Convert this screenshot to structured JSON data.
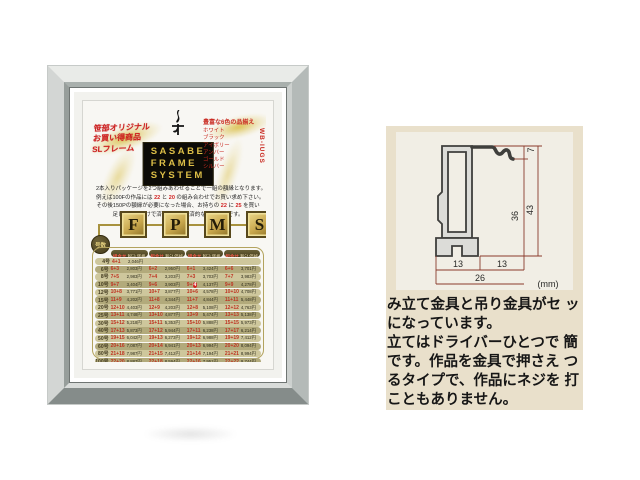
{
  "frame_photo": {
    "poster": {
      "promo_left_lines": [
        "笹部オリジナル",
        "お買い得商品",
        "SLフレーム"
      ],
      "brand_box_lines": [
        "SASABE",
        "FRAME",
        "SYSTEM"
      ],
      "colors_right": {
        "heading": "豊富な6色の品揃え",
        "names": [
          "ホワイト",
          "ブラック",
          "アイボリー",
          "アンバー",
          "ゴールド",
          "シルバー"
        ],
        "codes_vertical": "WB-IUGS"
      },
      "description_lines": [
        [
          {
            "t": "2本入りパッケージを2つ組みあわせることで一組の額縁となります。"
          }
        ],
        [
          {
            "t": "例えば100Fの作品には "
          },
          {
            "t": "22",
            "red": true
          },
          {
            "t": " と "
          },
          {
            "t": "20",
            "red": true
          },
          {
            "t": " の組み合わせでお買い求め下さい。"
          }
        ],
        [
          {
            "t": "その後150Pの額縁が必要になった場合、お持ちの "
          },
          {
            "t": "22",
            "red": true
          },
          {
            "t": " に "
          },
          {
            "t": "25",
            "red": true
          },
          {
            "t": " を買い"
          }
        ],
        [
          {
            "t": "足して頂くだけで済む、大変経済的なシステムです。"
          }
        ]
      ],
      "fpms_letters": [
        "F",
        "P",
        "M",
        "S"
      ],
      "size_circle_label": "号数",
      "table": {
        "header": {
          "combo": "組合せ",
          "price": "税込価格"
        },
        "rows": [
          {
            "size": "4号",
            "cells": [
              {
                "combo": "4+1",
                "price": "2,046円"
              }
            ]
          },
          {
            "size": "6号",
            "cells": [
              {
                "combo": "6+3",
                "price": "2,803円"
              },
              {
                "combo": "6+2",
                "price": "2,950円"
              },
              {
                "combo": "6+1",
                "price": "3,424円"
              },
              {
                "combo": "6+6",
                "price": "3,701円"
              }
            ]
          },
          {
            "size": "8号",
            "cells": [
              {
                "combo": "7+5",
                "price": "2,983円"
              },
              {
                "combo": "7+4",
                "price": "3,203円"
              },
              {
                "combo": "7+3",
                "price": "3,703円"
              },
              {
                "combo": "7+7",
                "price": "3,983円"
              }
            ]
          },
          {
            "size": "10号",
            "cells": [
              {
                "combo": "9+7",
                "price": "3,404円"
              },
              {
                "combo": "9+6",
                "price": "3,903円"
              },
              {
                "combo": "9+4",
                "price": "4,137円",
                "highlight": true
              },
              {
                "combo": "9+9",
                "price": "4,278円"
              }
            ]
          },
          {
            "size": "12号",
            "cells": [
              {
                "combo": "10+8",
                "price": "3,771円"
              },
              {
                "combo": "10+7",
                "price": "3,877円"
              },
              {
                "combo": "10+6",
                "price": "4,578円"
              },
              {
                "combo": "10+10",
                "price": "4,708円"
              }
            ]
          },
          {
            "size": "15号",
            "cells": [
              {
                "combo": "11+9",
                "price": "4,202円"
              },
              {
                "combo": "11+8",
                "price": "4,344円"
              },
              {
                "combo": "11+7",
                "price": "4,844円"
              },
              {
                "combo": "11+11",
                "price": "5,448円"
              }
            ]
          },
          {
            "size": "20号",
            "cells": [
              {
                "combo": "12+10",
                "price": "4,403円"
              },
              {
                "combo": "12+9",
                "price": "4,203円"
              },
              {
                "combo": "12+8",
                "price": "5,108円"
              },
              {
                "combo": "12+12",
                "price": "4,763円"
              }
            ]
          },
          {
            "size": "25号",
            "cells": [
              {
                "combo": "13+11",
                "price": "4,748円"
              },
              {
                "combo": "13+10",
                "price": "4,877円"
              },
              {
                "combo": "13+9",
                "price": "5,474円"
              },
              {
                "combo": "13+13",
                "price": "5,138円"
              }
            ]
          },
          {
            "size": "30号",
            "cells": [
              {
                "combo": "15+12",
                "price": "5,218円"
              },
              {
                "combo": "15+11",
                "price": "5,353円"
              },
              {
                "combo": "15+10",
                "price": "5,888円"
              },
              {
                "combo": "15+15",
                "price": "5,973円"
              }
            ]
          },
          {
            "size": "40号",
            "cells": [
              {
                "combo": "17+13",
                "price": "5,873円"
              },
              {
                "combo": "17+12",
                "price": "5,944円"
              },
              {
                "combo": "17+11",
                "price": "6,238円"
              },
              {
                "combo": "17+17",
                "price": "6,214円"
              }
            ]
          },
          {
            "size": "50号",
            "cells": [
              {
                "combo": "19+15",
                "price": "6,042円"
              },
              {
                "combo": "19+13",
                "price": "6,273円"
              },
              {
                "combo": "19+12",
                "price": "6,988円"
              },
              {
                "combo": "19+19",
                "price": "7,412円"
              }
            ]
          },
          {
            "size": "60号",
            "cells": [
              {
                "combo": "20+16",
                "price": "7,087円"
              },
              {
                "combo": "20+14",
                "price": "6,941円"
              },
              {
                "combo": "20+13",
                "price": "6,994円"
              },
              {
                "combo": "20+20",
                "price": "8,094円"
              }
            ]
          },
          {
            "size": "80号",
            "cells": [
              {
                "combo": "21+18",
                "price": "7,987円"
              },
              {
                "combo": "21+15",
                "price": "7,412円"
              },
              {
                "combo": "21+14",
                "price": "7,194円"
              },
              {
                "combo": "21+21",
                "price": "8,994円"
              }
            ]
          },
          {
            "size": "100号",
            "cells": [
              {
                "combo": "22+20",
                "price": "8,887円"
              },
              {
                "combo": "22+18",
                "price": "8,594円"
              },
              {
                "combo": "22+16",
                "price": "7,951円"
              },
              {
                "combo": "22+22",
                "price": "9,744円"
              }
            ]
          },
          {
            "size": "120号",
            "cells": [
              {
                "combo": "24+22",
                "price": "10,475円"
              },
              {
                "combo": "24+18",
                "price": "11,091円"
              },
              {
                "combo": "24+16",
                "price": "9,094円"
              },
              {
                "combo": "24+24",
                "price": "12,012円"
              }
            ]
          },
          {
            "size": "130号",
            "cells": [
              {
                "combo": "24+22",
                "price": "11,087円"
              }
            ]
          },
          {
            "size": "150号",
            "cells": [
              {
                "combo": "25+23",
                "price": "12,094円"
              },
              {
                "combo": "25+22",
                "price": "11,832円"
              },
              {
                "combo": "25+21",
                "price": "11,294円"
              },
              {
                "combo": "25+25",
                "price": "14,852円"
              }
            ]
          }
        ]
      }
    }
  },
  "spec_panel": {
    "diagram": {
      "dims": {
        "height_top": "7",
        "height_inner": "36",
        "height_total": "43",
        "width_left": "13",
        "width_right": "13",
        "width_total": "26",
        "unit": "(mm)"
      }
    },
    "text_lines": [
      "み立て金具と吊り金具がセ ッ",
      "になっています。",
      "立てはドライバーひとつで 簡",
      "です。作品を金具で押さえ つ",
      "るタイプで、作品にネジを 打",
      "こともありません。"
    ]
  }
}
